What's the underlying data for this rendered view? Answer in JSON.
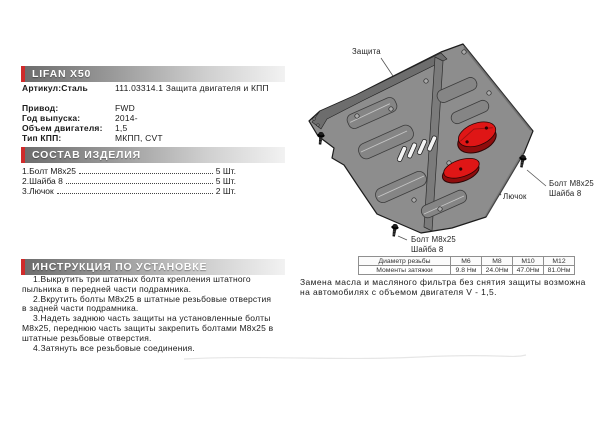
{
  "product": {
    "title": "LIFAN X50",
    "article_label": "Артикул:Сталь",
    "article_value": "111.03314.1 Защита двигателя и КПП",
    "specs": [
      {
        "label": "Привод:",
        "value": "FWD"
      },
      {
        "label": "Год выпуска:",
        "value": "2014-"
      },
      {
        "label": "Объем двигателя:",
        "value": "1,5"
      },
      {
        "label": "Тип КПП:",
        "value": "МКПП, CVT"
      }
    ]
  },
  "composition": {
    "title": "СОСТАВ ИЗДЕЛИЯ",
    "items": [
      {
        "name": "1.Болт M8x25",
        "qty": "5 Шт."
      },
      {
        "name": "2.Шайба 8",
        "qty": "5 Шт."
      },
      {
        "name": "3.Лючок",
        "qty": "2 Шт."
      }
    ]
  },
  "instructions": {
    "title": "ИНСТРУКЦИЯ ПО УСТАНОВКЕ",
    "steps": [
      "1.Выкрутить три штатных болта крепления штатного пыльника в передней части подрамника.",
      "2.Вкрутить болты M8x25 в штатные резьбовые отверстия в задней части подрамника.",
      "3.Надеть заднюю часть защиты на установленные болты M8x25, переднюю часть защиты закрепить болтами M8x25 в штатные резьбовые отверстия.",
      "4.Затянуть все резьбовые соединения."
    ]
  },
  "note": "Замена масла и масляного фильтра без снятия защиты возможна на автомобилях с объемом двигателя V - 1,5.",
  "diagram": {
    "labels": {
      "shield": "Защита",
      "hatch": "Лючок",
      "bolt_right_line1": "Болт M8x25",
      "bolt_right_line2": "Шайба 8",
      "bolt_bottom_line1": "Болт M8x25",
      "bolt_bottom_line2": "Шайба 8"
    }
  },
  "torque_table": {
    "header_row": [
      "Диаметр резьбы",
      "M6",
      "M8",
      "M10",
      "M12"
    ],
    "value_row": [
      "Моменты затяжки",
      "9.8 Нм",
      "24.0Нм",
      "47.0Нм",
      "81.0Нм"
    ]
  },
  "colors": {
    "accent_red": "#cf2b2b",
    "hatch_red": "#df1616",
    "plate_gray": "#8d8d8d"
  }
}
